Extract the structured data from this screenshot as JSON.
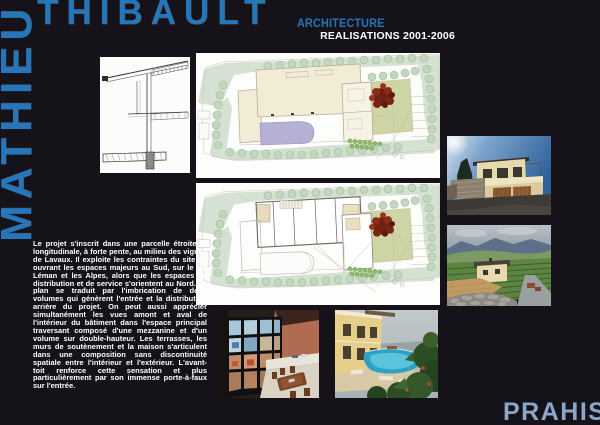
{
  "page": {
    "background_color": "#15121a",
    "accent_blue": "#2577b9",
    "footer_blue": "#8ca5c8",
    "text_white": "#ffffff"
  },
  "header": {
    "first_name_vertical": "MATHIEU",
    "last_name": "THIBAULT",
    "profession": "ARCHITECTURE",
    "series": "REALISATIONS 2001-2006"
  },
  "description": {
    "paragraph": "Le projet s'inscrit dans une parcelle étroite et longitudinale, à forte pente, au milieu des vignes de Lavaux. Il exploite les contraintes du site en ouvrant les espaces majeurs au Sud, sur le lac Léman et les Alpes, alors que les espaces de distribution et de service s'orientent au Nord. Le plan se traduit par l'imbrication de deux volumes qui génèrent l'entrée et la distribution arrière du projet. On peut aussi apprécier simultanément les vues amont et aval de l'intérieur du bâtiment dans l'espace principal traversant composé d'une mezzanine et d'un volume sur double-hauteur. Les terrasses, les murs de soutènement et la maison s'articulent dans une composition sans discontinuité spatiale entre l'intérieur et l'extérieur. L'avant-toit renforce cette sensation et plus particulièrement par son immense porte-à-faux sur l'entrée.",
    "project_location": "PRAHIS"
  }
}
